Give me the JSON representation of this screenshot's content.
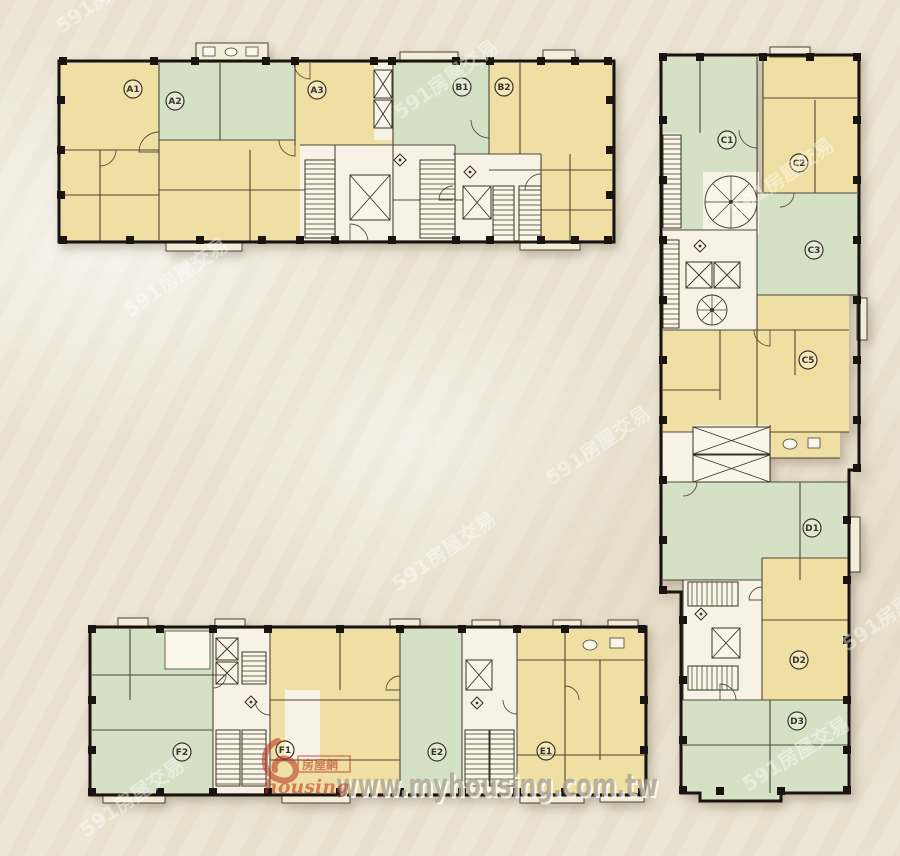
{
  "colors": {
    "background": "#ece4d3",
    "unit-yellow": "#f0dfa2",
    "unit-green": "#d5e1c5",
    "core-white": "#f7f2e5",
    "wall": "#191410",
    "line": "#332c20",
    "label-ink": "#39332a",
    "watermark-gray": "#a9a190",
    "logo-red": "#b5301c"
  },
  "units": [
    {
      "label": "A1",
      "color": "yellow"
    },
    {
      "label": "A2",
      "color": "green"
    },
    {
      "label": "A3",
      "color": "yellow"
    },
    {
      "label": "B1",
      "color": "green"
    },
    {
      "label": "B2",
      "color": "yellow"
    },
    {
      "label": "C1",
      "color": "green"
    },
    {
      "label": "C2",
      "color": "yellow"
    },
    {
      "label": "C3",
      "color": "green"
    },
    {
      "label": "C5",
      "color": "yellow"
    },
    {
      "label": "D1",
      "color": "green"
    },
    {
      "label": "D2",
      "color": "yellow"
    },
    {
      "label": "D3",
      "color": "green"
    },
    {
      "label": "F2",
      "color": "green"
    },
    {
      "label": "F1",
      "color": "yellow"
    },
    {
      "label": "E2",
      "color": "green"
    },
    {
      "label": "E1",
      "color": "yellow"
    }
  ],
  "watermarks": {
    "site": "591房屋交易",
    "url": "www.myhousing.com.tw",
    "logo_name": "房屋網",
    "logo_script": "housing"
  }
}
